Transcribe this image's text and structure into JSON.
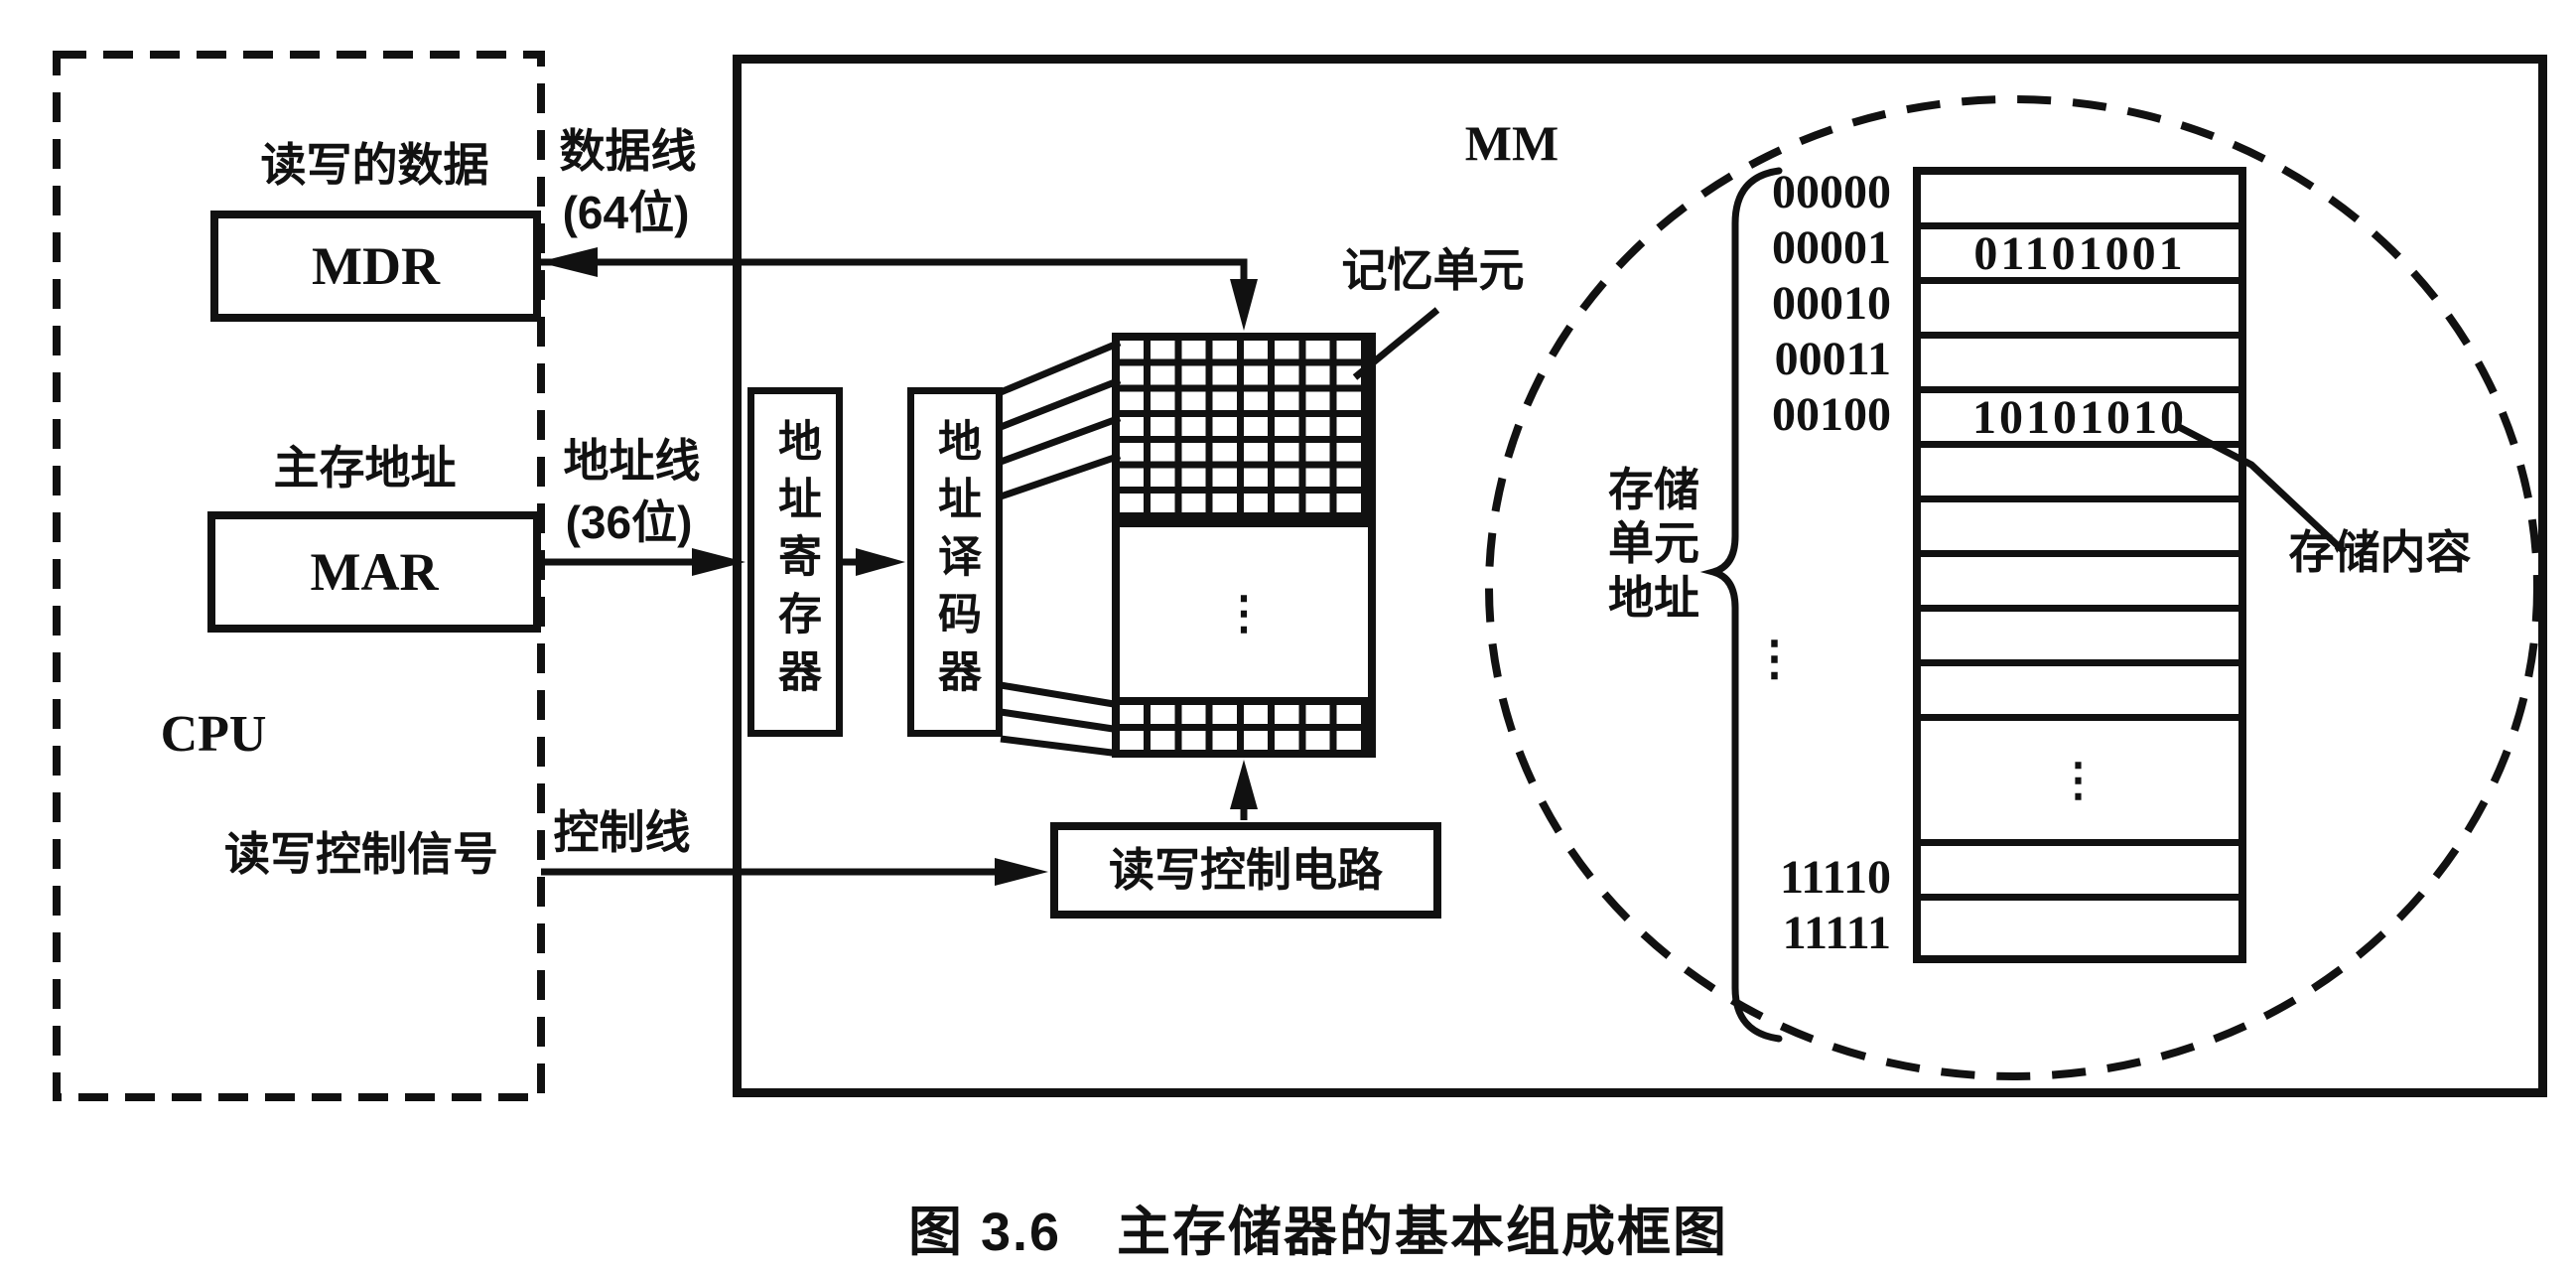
{
  "figure": {
    "caption": "图 3.6　主存储器的基本组成框图"
  },
  "cpu": {
    "label": "CPU",
    "mdr_title": "读写的数据",
    "mdr_label": "MDR",
    "mar_title": "主存地址",
    "mar_label": "MAR",
    "control_signal_label": "读写控制信号"
  },
  "buses": {
    "data_line_label": "数据线",
    "data_line_width": "(64位)",
    "address_line_label": "地址线",
    "address_line_width": "(36位)",
    "control_line_label": "控制线"
  },
  "mm": {
    "label": "MM",
    "address_register_label": "地址寄存器",
    "address_decoder_label": "地址译码器",
    "rw_control_label": "读写控制电路",
    "memory_cell_label": "记忆单元",
    "array_ellipsis": "⋮"
  },
  "memory_detail": {
    "unit_address_label": "存储\n单元\n地址",
    "content_label": "存储内容",
    "address_ellipsis": "⋮",
    "rows": [
      {
        "address": "00000",
        "content": ""
      },
      {
        "address": "00001",
        "content": "01101001"
      },
      {
        "address": "00010",
        "content": ""
      },
      {
        "address": "00011",
        "content": ""
      },
      {
        "address": "00100",
        "content": "10101010"
      },
      {
        "address": "",
        "content": ""
      },
      {
        "address": "",
        "content": ""
      },
      {
        "address": "",
        "content": ""
      },
      {
        "address": "",
        "content": ""
      },
      {
        "address": "",
        "content": ""
      },
      {
        "address": "",
        "content": "⋮"
      },
      {
        "address": "11110",
        "content": ""
      },
      {
        "address": "11111",
        "content": ""
      }
    ]
  },
  "colors": {
    "ink": "#111111",
    "background": "#ffffff"
  }
}
